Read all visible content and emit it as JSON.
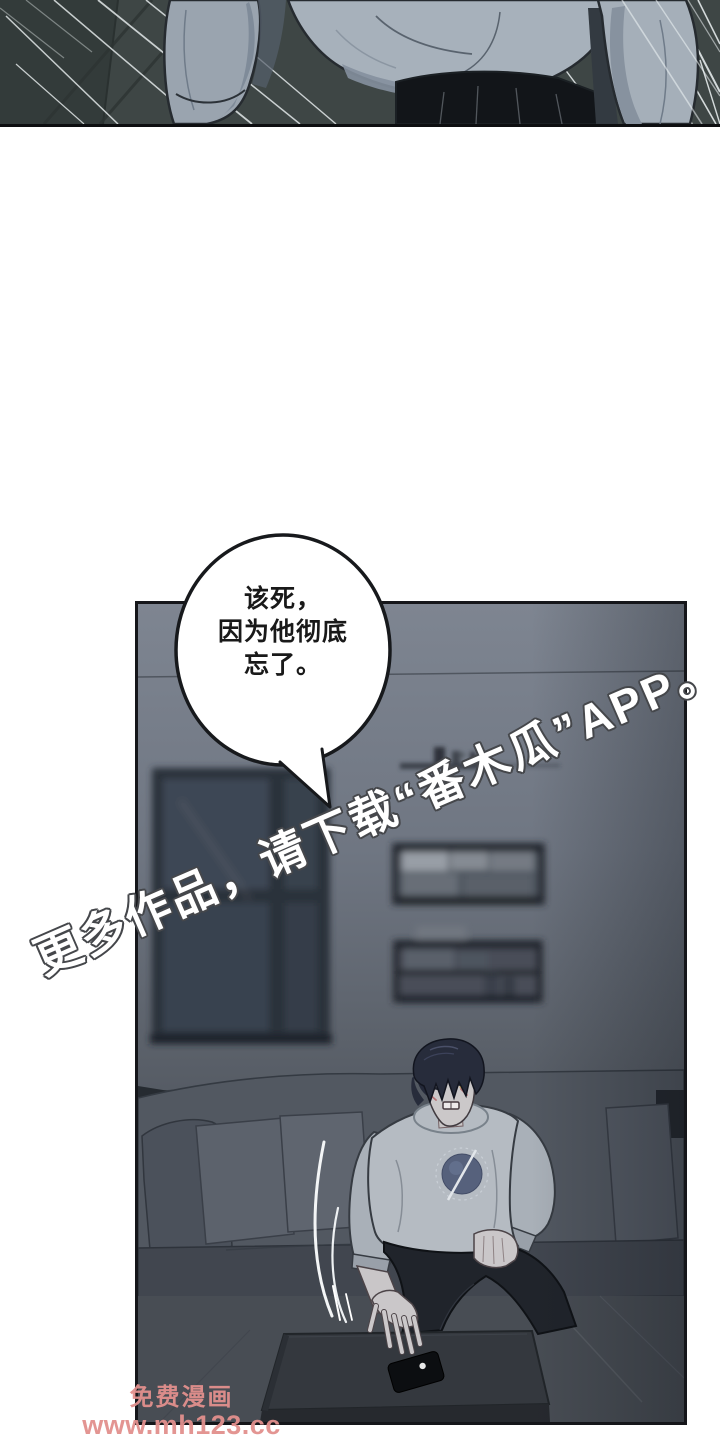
{
  "page": {
    "kind": "comic-page",
    "background": "#ffffff"
  },
  "bubble": {
    "lines": [
      "该死，",
      "因为他彻底",
      "忘了。"
    ]
  },
  "watermarks": {
    "app_promo": "更多作品，请下载“番木瓜”APP。",
    "site_name": "免费漫画",
    "site_url": "www.mh123.cc"
  },
  "scene_objects": [
    "standing-figure-closeup",
    "living-room",
    "window",
    "wall-shelf-upper",
    "wall-shelf-lower",
    "couch",
    "sitting-man",
    "coffee-table",
    "smartphone",
    "motion-lines"
  ],
  "colors": {
    "panel1_bg": "#3e4645",
    "panel1_bg_left": "#333b3a",
    "sweatshirt_top": "#a7b1bb",
    "sweatshirt": "#b5bbc2",
    "sleeve": "#9aa4af",
    "pants_top": "#121519",
    "pants": "#20242b",
    "hair": "#272c3b",
    "skin": "#cbc8c9",
    "wall_top": "#7e8591",
    "wall_bottom": "#383d45",
    "window_frame": "#2a313b",
    "window_pane": "#3e4754",
    "couch": "#525861",
    "cushion": "#5c626c",
    "table": "#34383e",
    "floor": "#484d54",
    "phone": "#0c0e11",
    "bubble_fill": "#ffffff",
    "bubble_outline": "#17191c",
    "watermark_text": "#ffffff",
    "watermark_outline": "#45474b",
    "site_watermark_pink": "#e2908d",
    "panel_border": "#15161a"
  }
}
